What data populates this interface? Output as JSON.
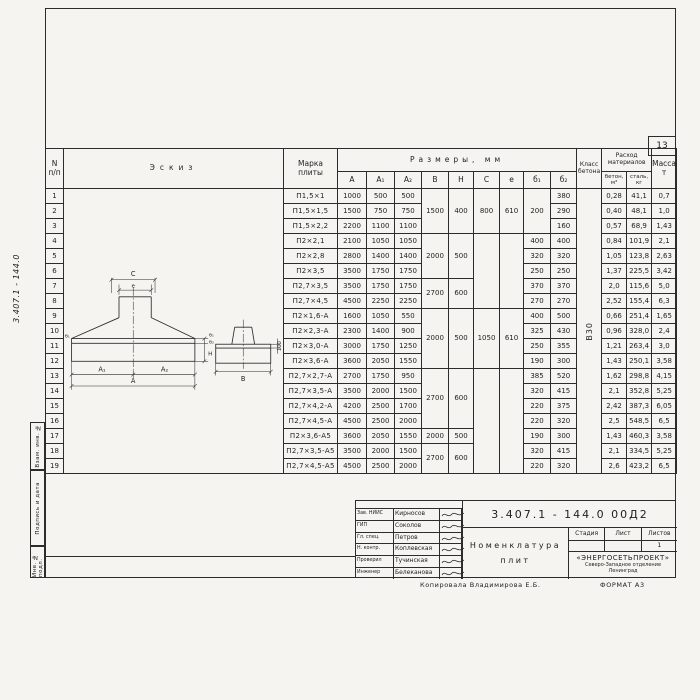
{
  "page": {
    "number": "13"
  },
  "frame": {
    "side_doc_number": "3.407.1 - 144.0",
    "stamps": [
      "Взам. инв. №",
      "Подпись и дата",
      "Инв. № подл."
    ]
  },
  "sketch": {
    "labels": {
      "c": "C",
      "e": "e",
      "a1": "A₁",
      "a2": "A₂",
      "a": "A",
      "b1": "б₁",
      "b2": "б₂",
      "h": "H",
      "b": "B",
      "edge": "100"
    }
  },
  "table": {
    "header": {
      "num": "N\nп/п",
      "sketch": "Эскиз",
      "marka": "Марка\nплиты",
      "sizes": "Размеры,  мм",
      "cols": [
        "A",
        "A₁",
        "A₂",
        "B",
        "H",
        "C",
        "e",
        "б₁",
        "б₂"
      ],
      "class_label": "Класс\nбетона",
      "consumption": "Расход\nматериалов",
      "concrete": "бетон,\nм³",
      "steel": "сталь,\nкг",
      "mass": "Масса,\nт"
    },
    "class_value": "В30",
    "b1_group": {
      "start": 1,
      "span": 3,
      "value": "200"
    },
    "bh_groups": [
      {
        "start": 1,
        "span": 3,
        "b": "1500",
        "h": "400"
      },
      {
        "start": 4,
        "span": 3,
        "b": "2000",
        "h": "500"
      },
      {
        "start": 7,
        "span": 2,
        "b": "2700",
        "h": "600"
      },
      {
        "start": 9,
        "span": 4,
        "b": "2000",
        "h": "500"
      },
      {
        "start": 13,
        "span": 4,
        "b": "2700",
        "h": "600"
      },
      {
        "start": 17,
        "span": 1,
        "b": "2000",
        "h": "500"
      },
      {
        "start": 18,
        "span": 2,
        "b": "2700",
        "h": "600"
      }
    ],
    "ce_groups": [
      {
        "start": 1,
        "span": 3,
        "c": "800",
        "e": "610"
      },
      {
        "start": 4,
        "span": 5,
        "c": "",
        "e": ""
      },
      {
        "start": 9,
        "span": 4,
        "c": "1050",
        "e": "610"
      },
      {
        "start": 13,
        "span": 7,
        "c": "",
        "e": ""
      }
    ],
    "rows": [
      {
        "n": "1",
        "marka": "П1,5×1",
        "a": "1000",
        "a1": "500",
        "a2": "500",
        "b1": "",
        "b2": "380",
        "beton": "0,28",
        "stal": "41,1",
        "massa": "0,7"
      },
      {
        "n": "2",
        "marka": "П1,5×1,5",
        "a": "1500",
        "a1": "750",
        "a2": "750",
        "b1": "",
        "b2": "290",
        "beton": "0,40",
        "stal": "48,1",
        "massa": "1,0"
      },
      {
        "n": "3",
        "marka": "П1,5×2,2",
        "a": "2200",
        "a1": "1100",
        "a2": "1100",
        "b1": "",
        "b2": "160",
        "beton": "0,57",
        "stal": "68,9",
        "massa": "1,43"
      },
      {
        "n": "4",
        "marka": "П2×2,1",
        "a": "2100",
        "a1": "1050",
        "a2": "1050",
        "b1": "400",
        "b2": "400",
        "beton": "0,84",
        "stal": "101,9",
        "massa": "2,1"
      },
      {
        "n": "5",
        "marka": "П2×2,8",
        "a": "2800",
        "a1": "1400",
        "a2": "1400",
        "b1": "320",
        "b2": "320",
        "beton": "1,05",
        "stal": "123,8",
        "massa": "2,63"
      },
      {
        "n": "6",
        "marka": "П2×3,5",
        "a": "3500",
        "a1": "1750",
        "a2": "1750",
        "b1": "250",
        "b2": "250",
        "beton": "1,37",
        "stal": "225,5",
        "massa": "3,42"
      },
      {
        "n": "7",
        "marka": "П2,7×3,5",
        "a": "3500",
        "a1": "1750",
        "a2": "1750",
        "b1": "370",
        "b2": "370",
        "beton": "2,0",
        "stal": "115,6",
        "massa": "5,0"
      },
      {
        "n": "8",
        "marka": "П2,7×4,5",
        "a": "4500",
        "a1": "2250",
        "a2": "2250",
        "b1": "270",
        "b2": "270",
        "beton": "2,52",
        "stal": "155,4",
        "massa": "6,3"
      },
      {
        "n": "9",
        "marka": "П2×1,6-А",
        "a": "1600",
        "a1": "1050",
        "a2": "550",
        "b1": "400",
        "b2": "500",
        "beton": "0,66",
        "stal": "251,4",
        "massa": "1,65"
      },
      {
        "n": "10",
        "marka": "П2×2,3-А",
        "a": "2300",
        "a1": "1400",
        "a2": "900",
        "b1": "325",
        "b2": "430",
        "beton": "0,96",
        "stal": "328,0",
        "massa": "2,4"
      },
      {
        "n": "11",
        "marka": "П2×3,0-А",
        "a": "3000",
        "a1": "1750",
        "a2": "1250",
        "b1": "250",
        "b2": "355",
        "beton": "1,21",
        "stal": "263,4",
        "massa": "3,0"
      },
      {
        "n": "12",
        "marka": "П2×3,6-А",
        "a": "3600",
        "a1": "2050",
        "a2": "1550",
        "b1": "190",
        "b2": "300",
        "beton": "1,43",
        "stal": "250,1",
        "massa": "3,58"
      },
      {
        "n": "13",
        "marka": "П2,7×2,7-А",
        "a": "2700",
        "a1": "1750",
        "a2": "950",
        "b1": "385",
        "b2": "520",
        "beton": "1,62",
        "stal": "298,8",
        "massa": "4,15"
      },
      {
        "n": "14",
        "marka": "П2,7×3,5-А",
        "a": "3500",
        "a1": "2000",
        "a2": "1500",
        "b1": "320",
        "b2": "415",
        "beton": "2,1",
        "stal": "352,8",
        "massa": "5,25"
      },
      {
        "n": "15",
        "marka": "П2,7×4,2-А",
        "a": "4200",
        "a1": "2500",
        "a2": "1700",
        "b1": "220",
        "b2": "375",
        "beton": "2,42",
        "stal": "387,3",
        "massa": "6,05"
      },
      {
        "n": "16",
        "marka": "П2,7×4,5-А",
        "a": "4500",
        "a1": "2500",
        "a2": "2000",
        "b1": "220",
        "b2": "320",
        "beton": "2,5",
        "stal": "548,5",
        "massa": "6,5"
      },
      {
        "n": "17",
        "marka": "П2×3,6-А5",
        "a": "3600",
        "a1": "2050",
        "a2": "1550",
        "b1": "190",
        "b2": "300",
        "beton": "1,43",
        "stal": "460,3",
        "massa": "3,58"
      },
      {
        "n": "18",
        "marka": "П2,7×3,5-А5",
        "a": "3500",
        "a1": "2000",
        "a2": "1500",
        "b1": "320",
        "b2": "415",
        "beton": "2,1",
        "stal": "334,5",
        "massa": "5,25"
      },
      {
        "n": "19",
        "marka": "П2,7×4,5-А5",
        "a": "4500",
        "a1": "2500",
        "a2": "2000",
        "b1": "220",
        "b2": "320",
        "beton": "2,6",
        "stal": "423,2",
        "massa": "6,5"
      }
    ]
  },
  "titleblock": {
    "doc_number": "3.407.1 - 144.0  00Д2",
    "title_line1": "Номенклатура",
    "title_line2": "плит",
    "stage_label": "Стадия",
    "sheet_label": "Лист",
    "sheets_label": "Листов",
    "stage_value": "",
    "sheet_value": "",
    "sheets_value": "1",
    "org_name": "«ЭНЕРГОСЕТЬПРОЕКТ»",
    "org_dept": "Северо-Западное отделение",
    "org_city": "Ленинград",
    "signatures": [
      {
        "role": "Зав. НИИС",
        "name": "Кирносов"
      },
      {
        "role": "ГИП",
        "name": "Соколов"
      },
      {
        "role": "Гл. спец.",
        "name": "Петров"
      },
      {
        "role": "Н. контр.",
        "name": "Коплевская"
      },
      {
        "role": "Проверил",
        "name": "Тучинская"
      },
      {
        "role": "Инженер",
        "name": "Белеканова"
      }
    ],
    "copy_note": "Копировала  Владимирова Е.Б.",
    "format_note": "ФОРМАТ А3"
  }
}
